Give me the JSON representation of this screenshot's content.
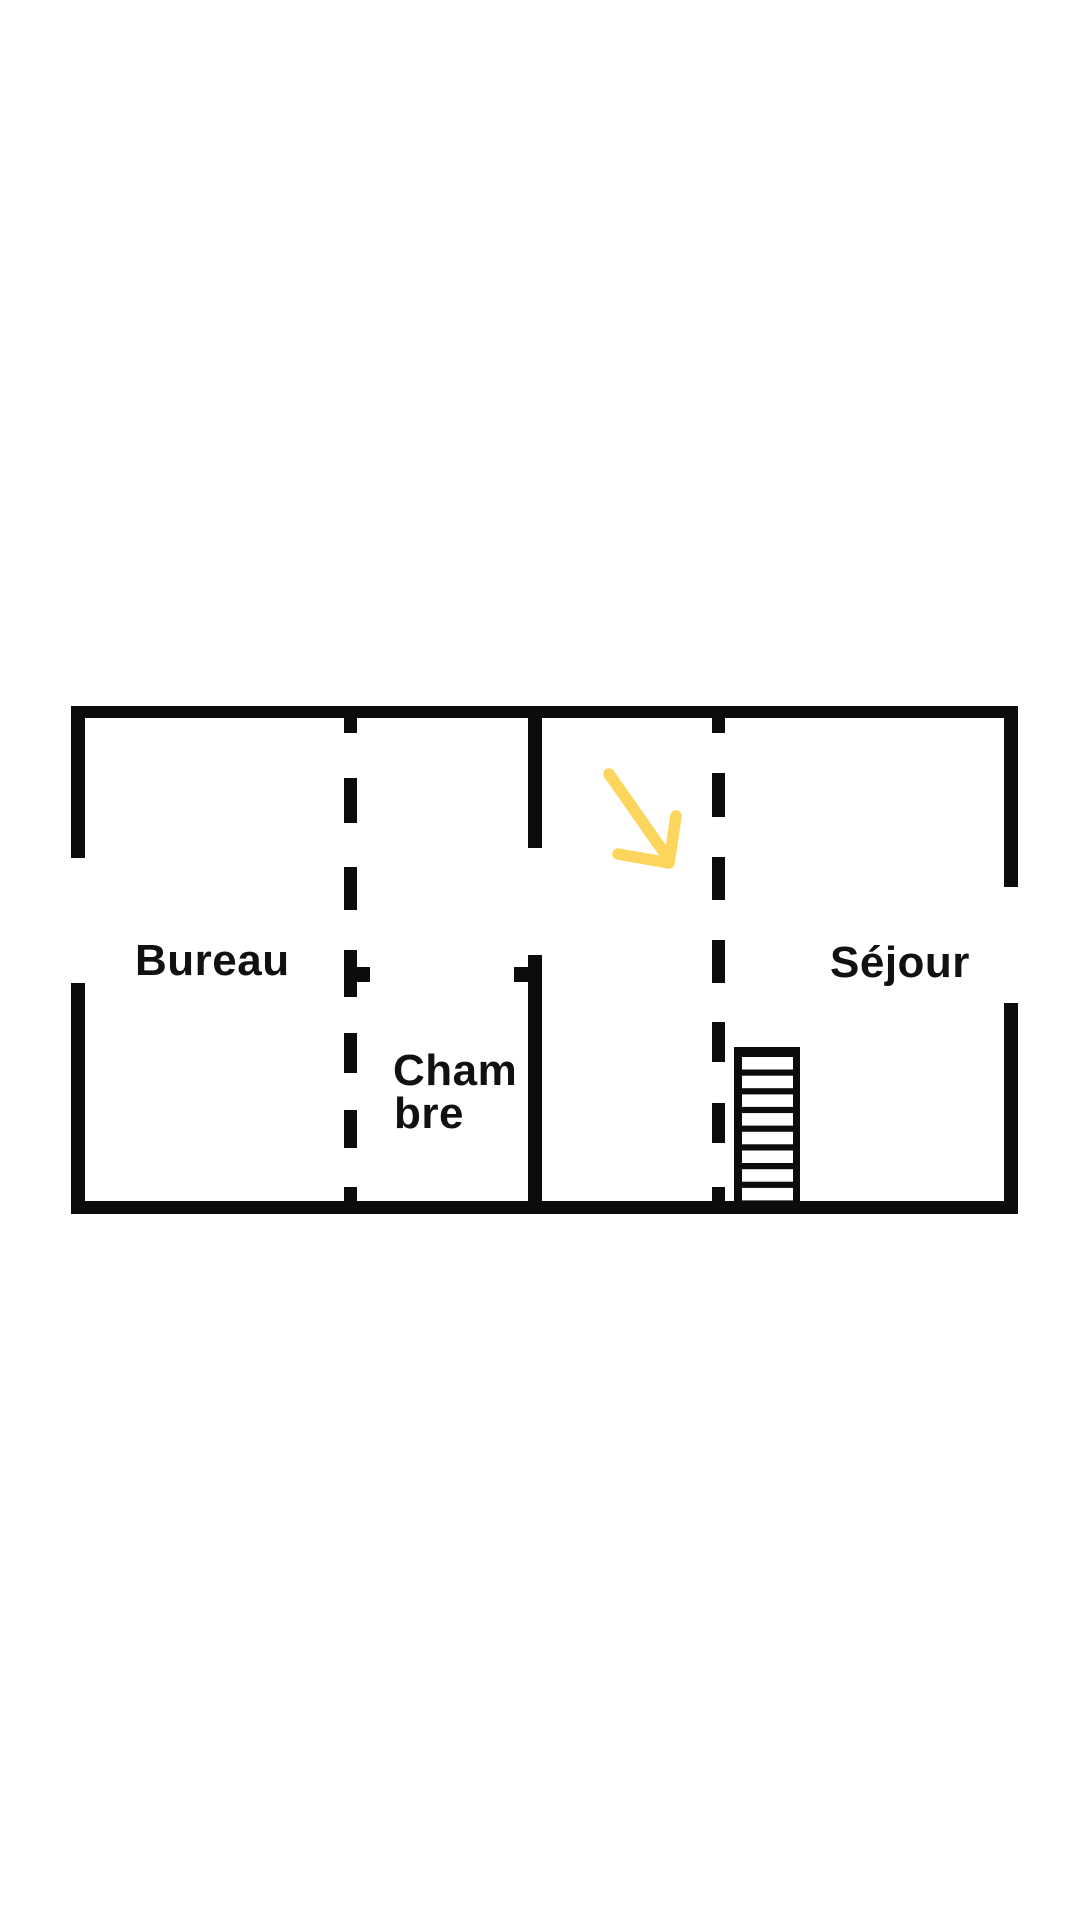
{
  "colors": {
    "background": "#ffffff",
    "wall": "#0c0c0c",
    "label": "#111111",
    "arrow": "#fbd55c"
  },
  "rooms": [
    {
      "name": "Bureau"
    },
    {
      "name": "Chambre",
      "lines": [
        "Cham",
        "bre"
      ]
    },
    {
      "name": "Séjour"
    }
  ],
  "stairs": {
    "visible_treads": 8
  }
}
